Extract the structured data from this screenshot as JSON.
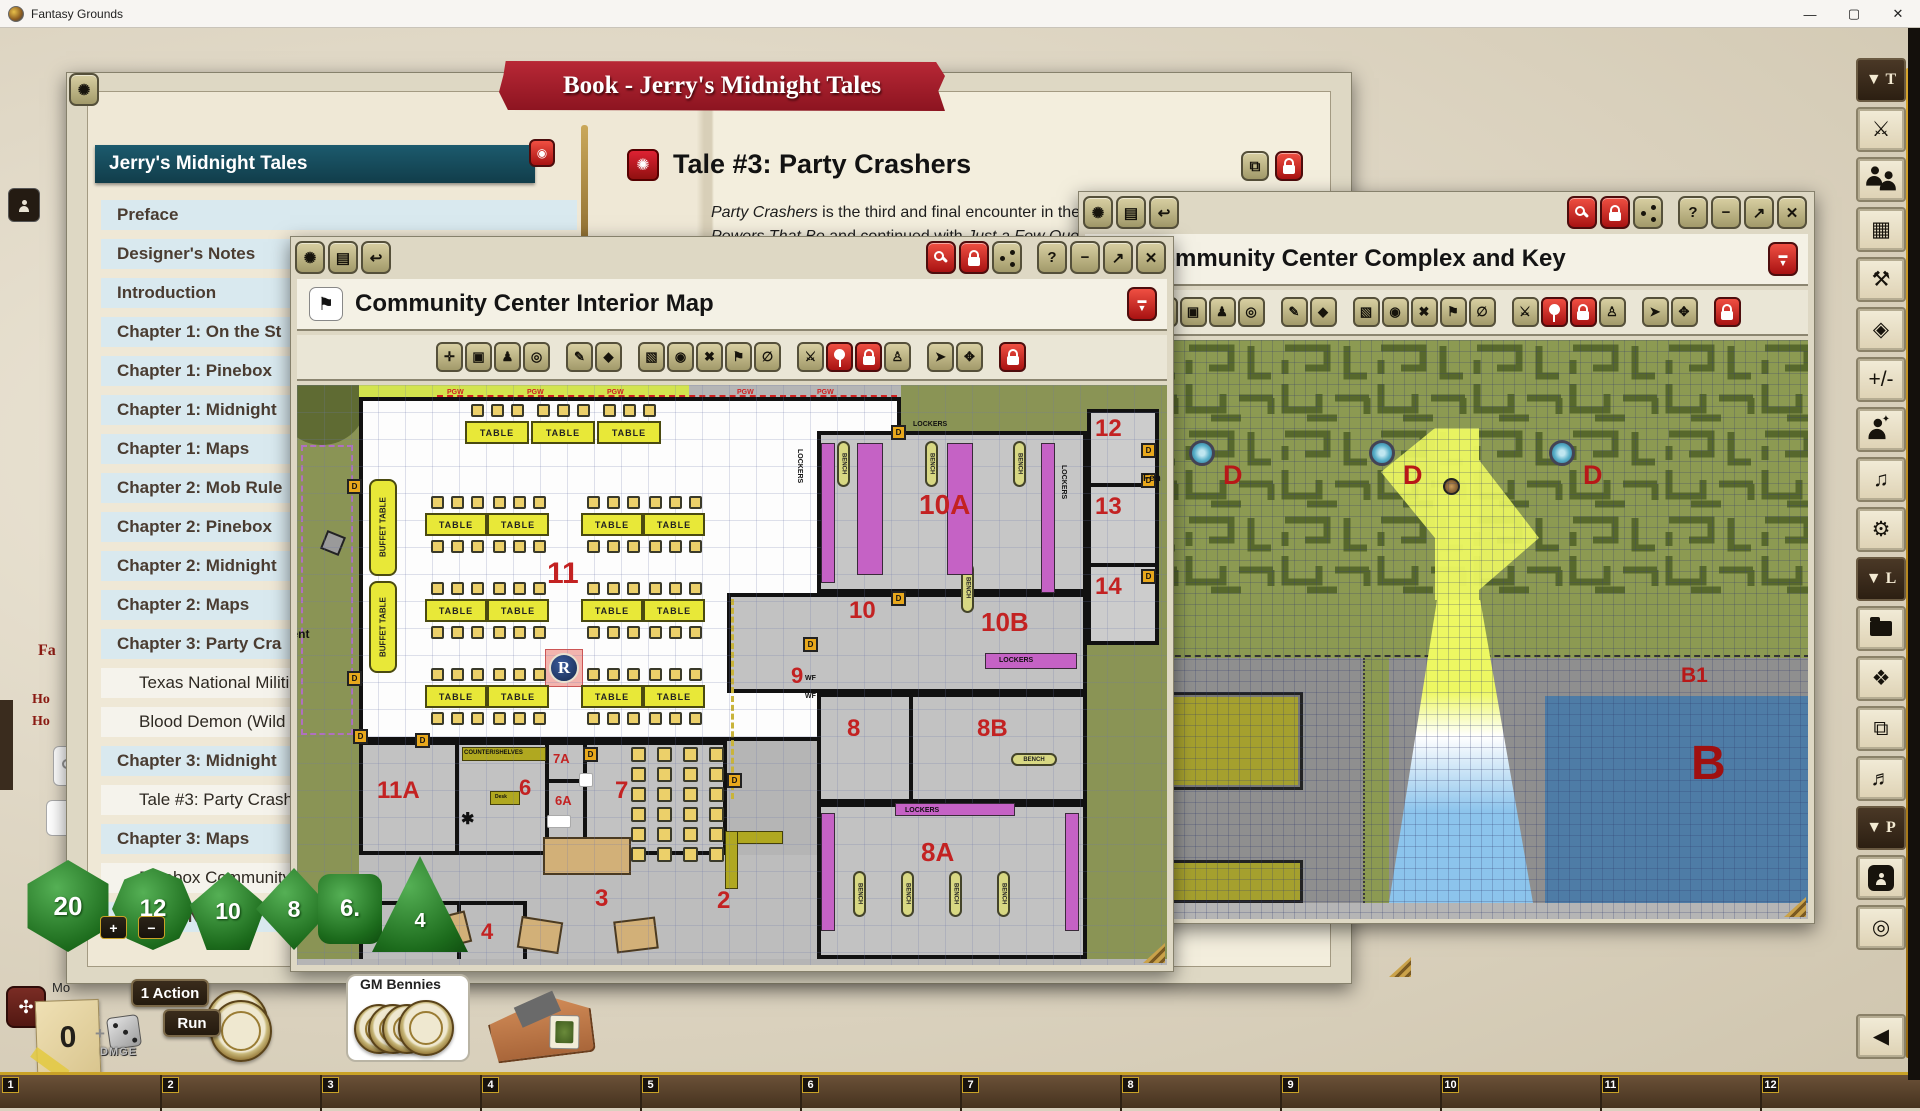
{
  "titlebar": {
    "app_title": "Fantasy Grounds",
    "minimize": "—",
    "maximize": "▢",
    "close": "✕"
  },
  "chrome": {
    "left": [
      {
        "name": "fg-logo-icon",
        "glyph": "✺"
      },
      {
        "name": "book-icon",
        "glyph": "▤"
      },
      {
        "name": "undo-icon",
        "glyph": "↩"
      }
    ],
    "right": [
      {
        "name": "zoom-icon",
        "type": "mag",
        "red": true
      },
      {
        "name": "lock-icon",
        "type": "lock",
        "red": true
      },
      {
        "name": "share-icon",
        "type": "share"
      },
      {
        "name": "help-button",
        "glyph": "?",
        "gap": true
      },
      {
        "name": "minimize-button",
        "glyph": "−"
      },
      {
        "name": "maximize-button",
        "glyph": "↗"
      },
      {
        "name": "close-button",
        "glyph": "✕"
      }
    ]
  },
  "map_toolbar": [
    {
      "name": "fit-icon",
      "glyph": "✛"
    },
    {
      "name": "camera-icon",
      "glyph": "▣"
    },
    {
      "name": "player-view-icon",
      "glyph": "♟"
    },
    {
      "name": "target-icon",
      "glyph": "◎"
    },
    {
      "name": "draw-icon",
      "glyph": "✎",
      "gap": true
    },
    {
      "name": "eraser-icon",
      "glyph": "◆"
    },
    {
      "name": "select-icon",
      "glyph": "▧",
      "gap": true
    },
    {
      "name": "bullseye-icon",
      "glyph": "◉"
    },
    {
      "name": "remove-icon",
      "glyph": "✖"
    },
    {
      "name": "flag-icon",
      "glyph": "⚑"
    },
    {
      "name": "null-icon",
      "glyph": "∅"
    },
    {
      "name": "combat-icon",
      "glyph": "⚔",
      "gap": true
    },
    {
      "name": "pin-icon",
      "type": "pin",
      "red": true
    },
    {
      "name": "unlock-token-icon",
      "type": "lock",
      "red": true
    },
    {
      "name": "token-vision-icon",
      "glyph": "♙"
    },
    {
      "name": "pointer-icon",
      "glyph": "➤",
      "gap": true
    },
    {
      "name": "move-icon",
      "glyph": "✥"
    },
    {
      "name": "map-lock-icon",
      "type": "lock",
      "red": true,
      "gap": true
    }
  ],
  "book": {
    "banner": "Book - Jerry's Midnight Tales",
    "toc_header": "Jerry's Midnight Tales",
    "toc_items": [
      {
        "label": "Preface",
        "level": 0
      },
      {
        "label": "Designer's Notes",
        "level": 0
      },
      {
        "label": "Introduction",
        "level": 0
      },
      {
        "label": "Chapter 1: On the St",
        "level": 0
      },
      {
        "label": "Chapter 1: Pinebox",
        "level": 0
      },
      {
        "label": "Chapter 1: Midnight",
        "level": 0
      },
      {
        "label": "Chapter 1: Maps",
        "level": 0
      },
      {
        "label": "Chapter 2: Mob Rule",
        "level": 0
      },
      {
        "label": "Chapter 2: Pinebox",
        "level": 0
      },
      {
        "label": "Chapter 2: Midnight",
        "level": 0
      },
      {
        "label": "Chapter 2: Maps",
        "level": 0
      },
      {
        "label": "Chapter 3: Party Cra",
        "level": 0
      },
      {
        "label": "Texas National Militi",
        "level": 1
      },
      {
        "label": "Blood Demon (Wild",
        "level": 1
      },
      {
        "label": "Chapter 3: Midnight",
        "level": 0
      },
      {
        "label": "Tale #3: Party Crash",
        "level": 1
      },
      {
        "label": "Chapter 3: Maps",
        "level": 0
      },
      {
        "label": "Pinebox Community",
        "level": 1
      },
      {
        "label": "Pinebox News",
        "level": 0
      }
    ],
    "tale": {
      "title": "Tale #3: Party Crashers",
      "p1": [
        {
          "t": "Party Crashers",
          "i": true
        },
        {
          "t": " is the third and final encounter in the adventure",
          "i": false
        }
      ],
      "p2": [
        {
          "t": "Powers That Be",
          "i": true
        },
        {
          "t": " and continued with ",
          "i": false
        },
        {
          "t": "Just a Few Questions",
          "i": true
        },
        {
          "t": " . These",
          "i": false
        }
      ]
    }
  },
  "interior_map": {
    "title": "Community Center Interior Map",
    "labels": [
      {
        "text": "11",
        "x": 250,
        "y": 172,
        "size": 30,
        "color": "#c32222"
      },
      {
        "text": "11A",
        "x": 80,
        "y": 392,
        "size": 24,
        "color": "#c32222"
      },
      {
        "text": "12",
        "x": 798,
        "y": 30,
        "size": 24,
        "color": "#c32222"
      },
      {
        "text": "13",
        "x": 798,
        "y": 108,
        "size": 24,
        "color": "#c32222"
      },
      {
        "text": "14",
        "x": 798,
        "y": 188,
        "size": 24,
        "color": "#c32222"
      },
      {
        "text": "10",
        "x": 552,
        "y": 212,
        "size": 24,
        "color": "#c32222"
      },
      {
        "text": "10A",
        "x": 622,
        "y": 104,
        "size": 28,
        "color": "#c32222"
      },
      {
        "text": "10B",
        "x": 684,
        "y": 222,
        "size": 26,
        "color": "#c32222"
      },
      {
        "text": "9",
        "x": 494,
        "y": 278,
        "size": 22,
        "color": "#c32222"
      },
      {
        "text": "8",
        "x": 550,
        "y": 330,
        "size": 24,
        "color": "#c32222"
      },
      {
        "text": "8B",
        "x": 680,
        "y": 330,
        "size": 24,
        "color": "#c32222"
      },
      {
        "text": "8A",
        "x": 624,
        "y": 452,
        "size": 26,
        "color": "#c32222"
      },
      {
        "text": "7",
        "x": 318,
        "y": 392,
        "size": 24,
        "color": "#c32222"
      },
      {
        "text": "7A",
        "x": 256,
        "y": 366,
        "size": 13,
        "color": "#c32222"
      },
      {
        "text": "6",
        "x": 222,
        "y": 390,
        "size": 22,
        "color": "#c32222"
      },
      {
        "text": "6A",
        "x": 258,
        "y": 408,
        "size": 13,
        "color": "#c32222"
      },
      {
        "text": "5",
        "x": 108,
        "y": 530,
        "size": 22,
        "color": "#c32222"
      },
      {
        "text": "4",
        "x": 184,
        "y": 534,
        "size": 22,
        "color": "#c32222"
      },
      {
        "text": "3",
        "x": 298,
        "y": 500,
        "size": 24,
        "color": "#c32222"
      },
      {
        "text": "2",
        "x": 420,
        "y": 502,
        "size": 24,
        "color": "#c32222"
      },
      {
        "text": "LOCKERS",
        "x": 616,
        "y": 36,
        "size": 7,
        "color": "#111"
      },
      {
        "text": "LOCKERS",
        "x": 506,
        "y": 64,
        "size": 7,
        "color": "#111",
        "rot": 90
      },
      {
        "text": "LOCKERS",
        "x": 770,
        "y": 80,
        "size": 7,
        "color": "#111",
        "rot": 90
      },
      {
        "text": "LOCKERS",
        "x": 702,
        "y": 272,
        "size": 7,
        "color": "#111"
      },
      {
        "text": "LOCKERS",
        "x": 608,
        "y": 422,
        "size": 7,
        "color": "#111"
      },
      {
        "text": "COUNTER/SHELVES",
        "x": 167,
        "y": 365,
        "size": 6,
        "color": "#111"
      },
      {
        "text": "Desk",
        "x": 198,
        "y": 409,
        "size": 5,
        "color": "#111"
      },
      {
        "text": "S",
        "x": 287,
        "y": 392,
        "size": 7,
        "color": "#111"
      },
      {
        "text": "File",
        "x": 256,
        "y": 434,
        "size": 5,
        "color": "#111"
      },
      {
        "text": "WF",
        "x": 508,
        "y": 290,
        "size": 7,
        "color": "#111"
      },
      {
        "text": "WF",
        "x": 508,
        "y": 308,
        "size": 7,
        "color": "#111"
      },
      {
        "text": "Tent",
        "x": -12,
        "y": 242,
        "size": 12,
        "color": "#111"
      },
      {
        "text": "Fen",
        "x": 846,
        "y": 88,
        "size": 10,
        "color": "#111"
      },
      {
        "text": "✱",
        "x": 164,
        "y": 424,
        "size": 16,
        "color": "#111"
      },
      {
        "text": "PGW",
        "x": 150,
        "y": 4,
        "size": 7,
        "color": "#d02020"
      },
      {
        "text": "PGW",
        "x": 230,
        "y": 4,
        "size": 7,
        "color": "#d02020"
      },
      {
        "text": "PGW",
        "x": 310,
        "y": 4,
        "size": 7,
        "color": "#d02020"
      },
      {
        "text": "PGW",
        "x": 440,
        "y": 4,
        "size": 7,
        "color": "#d02020"
      },
      {
        "text": "PGW",
        "x": 520,
        "y": 4,
        "size": 7,
        "color": "#d02020"
      }
    ],
    "tables": [
      {
        "x": 168,
        "y": 36,
        "w": 64,
        "h": 23,
        "label": "TABLE",
        "chairs": "above"
      },
      {
        "x": 234,
        "y": 36,
        "w": 64,
        "h": 23,
        "label": "TABLE",
        "chairs": "above"
      },
      {
        "x": 300,
        "y": 36,
        "w": 64,
        "h": 23,
        "label": "TABLE",
        "chairs": "above"
      },
      {
        "x": 128,
        "y": 128,
        "w": 62,
        "h": 23,
        "label": "TABLE",
        "chairs": "both"
      },
      {
        "x": 190,
        "y": 128,
        "w": 62,
        "h": 23,
        "label": "TABLE",
        "chairs": "both"
      },
      {
        "x": 284,
        "y": 128,
        "w": 62,
        "h": 23,
        "label": "TABLE",
        "chairs": "both"
      },
      {
        "x": 346,
        "y": 128,
        "w": 62,
        "h": 23,
        "label": "TABLE",
        "chairs": "both"
      },
      {
        "x": 128,
        "y": 214,
        "w": 62,
        "h": 23,
        "label": "TABLE",
        "chairs": "both"
      },
      {
        "x": 190,
        "y": 214,
        "w": 62,
        "h": 23,
        "label": "TABLE",
        "chairs": "both"
      },
      {
        "x": 284,
        "y": 214,
        "w": 62,
        "h": 23,
        "label": "TABLE",
        "chairs": "both"
      },
      {
        "x": 346,
        "y": 214,
        "w": 62,
        "h": 23,
        "label": "TABLE",
        "chairs": "both"
      },
      {
        "x": 128,
        "y": 300,
        "w": 62,
        "h": 23,
        "label": "TABLE",
        "chairs": "both"
      },
      {
        "x": 190,
        "y": 300,
        "w": 62,
        "h": 23,
        "label": "TABLE",
        "chairs": "both"
      },
      {
        "x": 284,
        "y": 300,
        "w": 62,
        "h": 23,
        "label": "TABLE",
        "chairs": "both"
      },
      {
        "x": 346,
        "y": 300,
        "w": 62,
        "h": 23,
        "label": "TABLE",
        "chairs": "both"
      },
      {
        "x": 72,
        "y": 94,
        "w": 28,
        "h": 97,
        "label": "BUFFET TABLE",
        "vertical": true
      },
      {
        "x": 72,
        "y": 196,
        "w": 28,
        "h": 92,
        "label": "BUFFET TABLE",
        "vertical": true
      }
    ],
    "benches": [
      {
        "x": 540,
        "y": 56,
        "w": 13,
        "h": 46,
        "label": "BENCH",
        "vertical": true
      },
      {
        "x": 628,
        "y": 56,
        "w": 13,
        "h": 46,
        "label": "BENCH",
        "vertical": true
      },
      {
        "x": 716,
        "y": 56,
        "w": 13,
        "h": 46,
        "label": "BENCH",
        "vertical": true
      },
      {
        "x": 664,
        "y": 178,
        "w": 13,
        "h": 50,
        "label": "BENCH",
        "vertical": true
      },
      {
        "x": 714,
        "y": 368,
        "w": 46,
        "h": 13,
        "label": "BENCH"
      },
      {
        "x": 556,
        "y": 486,
        "w": 13,
        "h": 46,
        "label": "BENCH",
        "vertical": true
      },
      {
        "x": 604,
        "y": 486,
        "w": 13,
        "h": 46,
        "label": "BENCH",
        "vertical": true
      },
      {
        "x": 652,
        "y": 486,
        "w": 13,
        "h": 46,
        "label": "BENCH",
        "vertical": true
      },
      {
        "x": 700,
        "y": 486,
        "w": 13,
        "h": 46,
        "label": "BENCH",
        "vertical": true
      }
    ],
    "lockers": [
      {
        "x": 524,
        "y": 58,
        "w": 14,
        "h": 140
      },
      {
        "x": 560,
        "y": 58,
        "w": 26,
        "h": 132
      },
      {
        "x": 650,
        "y": 58,
        "w": 26,
        "h": 132
      },
      {
        "x": 744,
        "y": 58,
        "w": 14,
        "h": 150
      },
      {
        "x": 688,
        "y": 268,
        "w": 92,
        "h": 16
      },
      {
        "x": 524,
        "y": 428,
        "w": 14,
        "h": 118
      },
      {
        "x": 598,
        "y": 418,
        "w": 120,
        "h": 13
      },
      {
        "x": 768,
        "y": 428,
        "w": 14,
        "h": 118
      }
    ],
    "doors": [
      {
        "x": 50,
        "y": 94
      },
      {
        "x": 50,
        "y": 286
      },
      {
        "x": 118,
        "y": 348
      },
      {
        "x": 286,
        "y": 362
      },
      {
        "x": 430,
        "y": 388
      },
      {
        "x": 594,
        "y": 40
      },
      {
        "x": 594,
        "y": 206
      },
      {
        "x": 844,
        "y": 58
      },
      {
        "x": 844,
        "y": 88
      },
      {
        "x": 844,
        "y": 184
      },
      {
        "x": 506,
        "y": 252
      },
      {
        "x": 56,
        "y": 344
      }
    ],
    "chair_grids": [
      {
        "x": 334,
        "y": 362,
        "cols": 4,
        "rows": 3,
        "dx": 26,
        "dy": 20
      },
      {
        "x": 334,
        "y": 422,
        "cols": 4,
        "rows": 3,
        "dx": 26,
        "dy": 20
      }
    ],
    "token": {
      "letter": "R"
    }
  },
  "complex_map": {
    "title": "Community Center Complex and Key",
    "labels": [
      {
        "text": "D",
        "x": 138,
        "y": 120,
        "size": 27,
        "color": "#b81818"
      },
      {
        "text": "D",
        "x": 318,
        "y": 120,
        "size": 27,
        "color": "#b81818"
      },
      {
        "text": "D",
        "x": 498,
        "y": 120,
        "size": 27,
        "color": "#b81818"
      },
      {
        "text": "B1",
        "x": 596,
        "y": 324,
        "size": 21,
        "color": "#b81818"
      },
      {
        "text": "B",
        "x": 606,
        "y": 396,
        "size": 48,
        "color": "#a01010"
      }
    ],
    "fountains": [
      {
        "x": 104,
        "y": 100
      },
      {
        "x": 284,
        "y": 100
      },
      {
        "x": 464,
        "y": 100
      }
    ]
  },
  "sidebar": [
    {
      "header": "▼ T",
      "name": "tools-section-header"
    },
    {
      "icon": "swords",
      "name": "combat-tracker-button"
    },
    {
      "icon": "people",
      "name": "party-sheet-button"
    },
    {
      "icon": "calendar",
      "name": "calendar-button"
    },
    {
      "icon": "wrench",
      "name": "options-button"
    },
    {
      "icon": "d20",
      "name": "dice-tower-button"
    },
    {
      "icon": "plusminus",
      "name": "modifiers-button"
    },
    {
      "icon": "person-effects",
      "name": "effects-button"
    },
    {
      "icon": "music",
      "name": "sound-button"
    },
    {
      "icon": "gear",
      "name": "settings-button"
    },
    {
      "header": "▼ L",
      "name": "library-section-header"
    },
    {
      "icon": "folder",
      "name": "library-button"
    },
    {
      "icon": "puzzle",
      "name": "modules-button"
    },
    {
      "icon": "images",
      "name": "images-button"
    },
    {
      "icon": "music2",
      "name": "audio-button"
    },
    {
      "header": "▼ P",
      "name": "player-section-header"
    },
    {
      "icon": "person-hex",
      "name": "characters-button"
    },
    {
      "icon": "rings",
      "name": "tokens-button"
    },
    {
      "icon": "collapse",
      "name": "collapse-sidebar-button",
      "last": true
    }
  ],
  "hotbar": {
    "numbers": [
      "1",
      "2",
      "3",
      "4",
      "5",
      "6",
      "7",
      "8",
      "9",
      "10",
      "11",
      "12"
    ]
  },
  "controls": {
    "zero": "0",
    "action": "1 Action",
    "run": "Run",
    "gm_bennies": "GM Bennies",
    "dmg_plus": "+",
    "dmg_word": "DMGE",
    "mo": "Mo"
  },
  "fragments": {
    "fa": "Fa",
    "ho1": "Ho",
    "ho2": "Ho"
  },
  "dice": {
    "d20": "20",
    "d12": "12",
    "d10": "10",
    "d8": "8",
    "d6": "6.",
    "d4": "4",
    "plus": "+",
    "minus": "−"
  }
}
